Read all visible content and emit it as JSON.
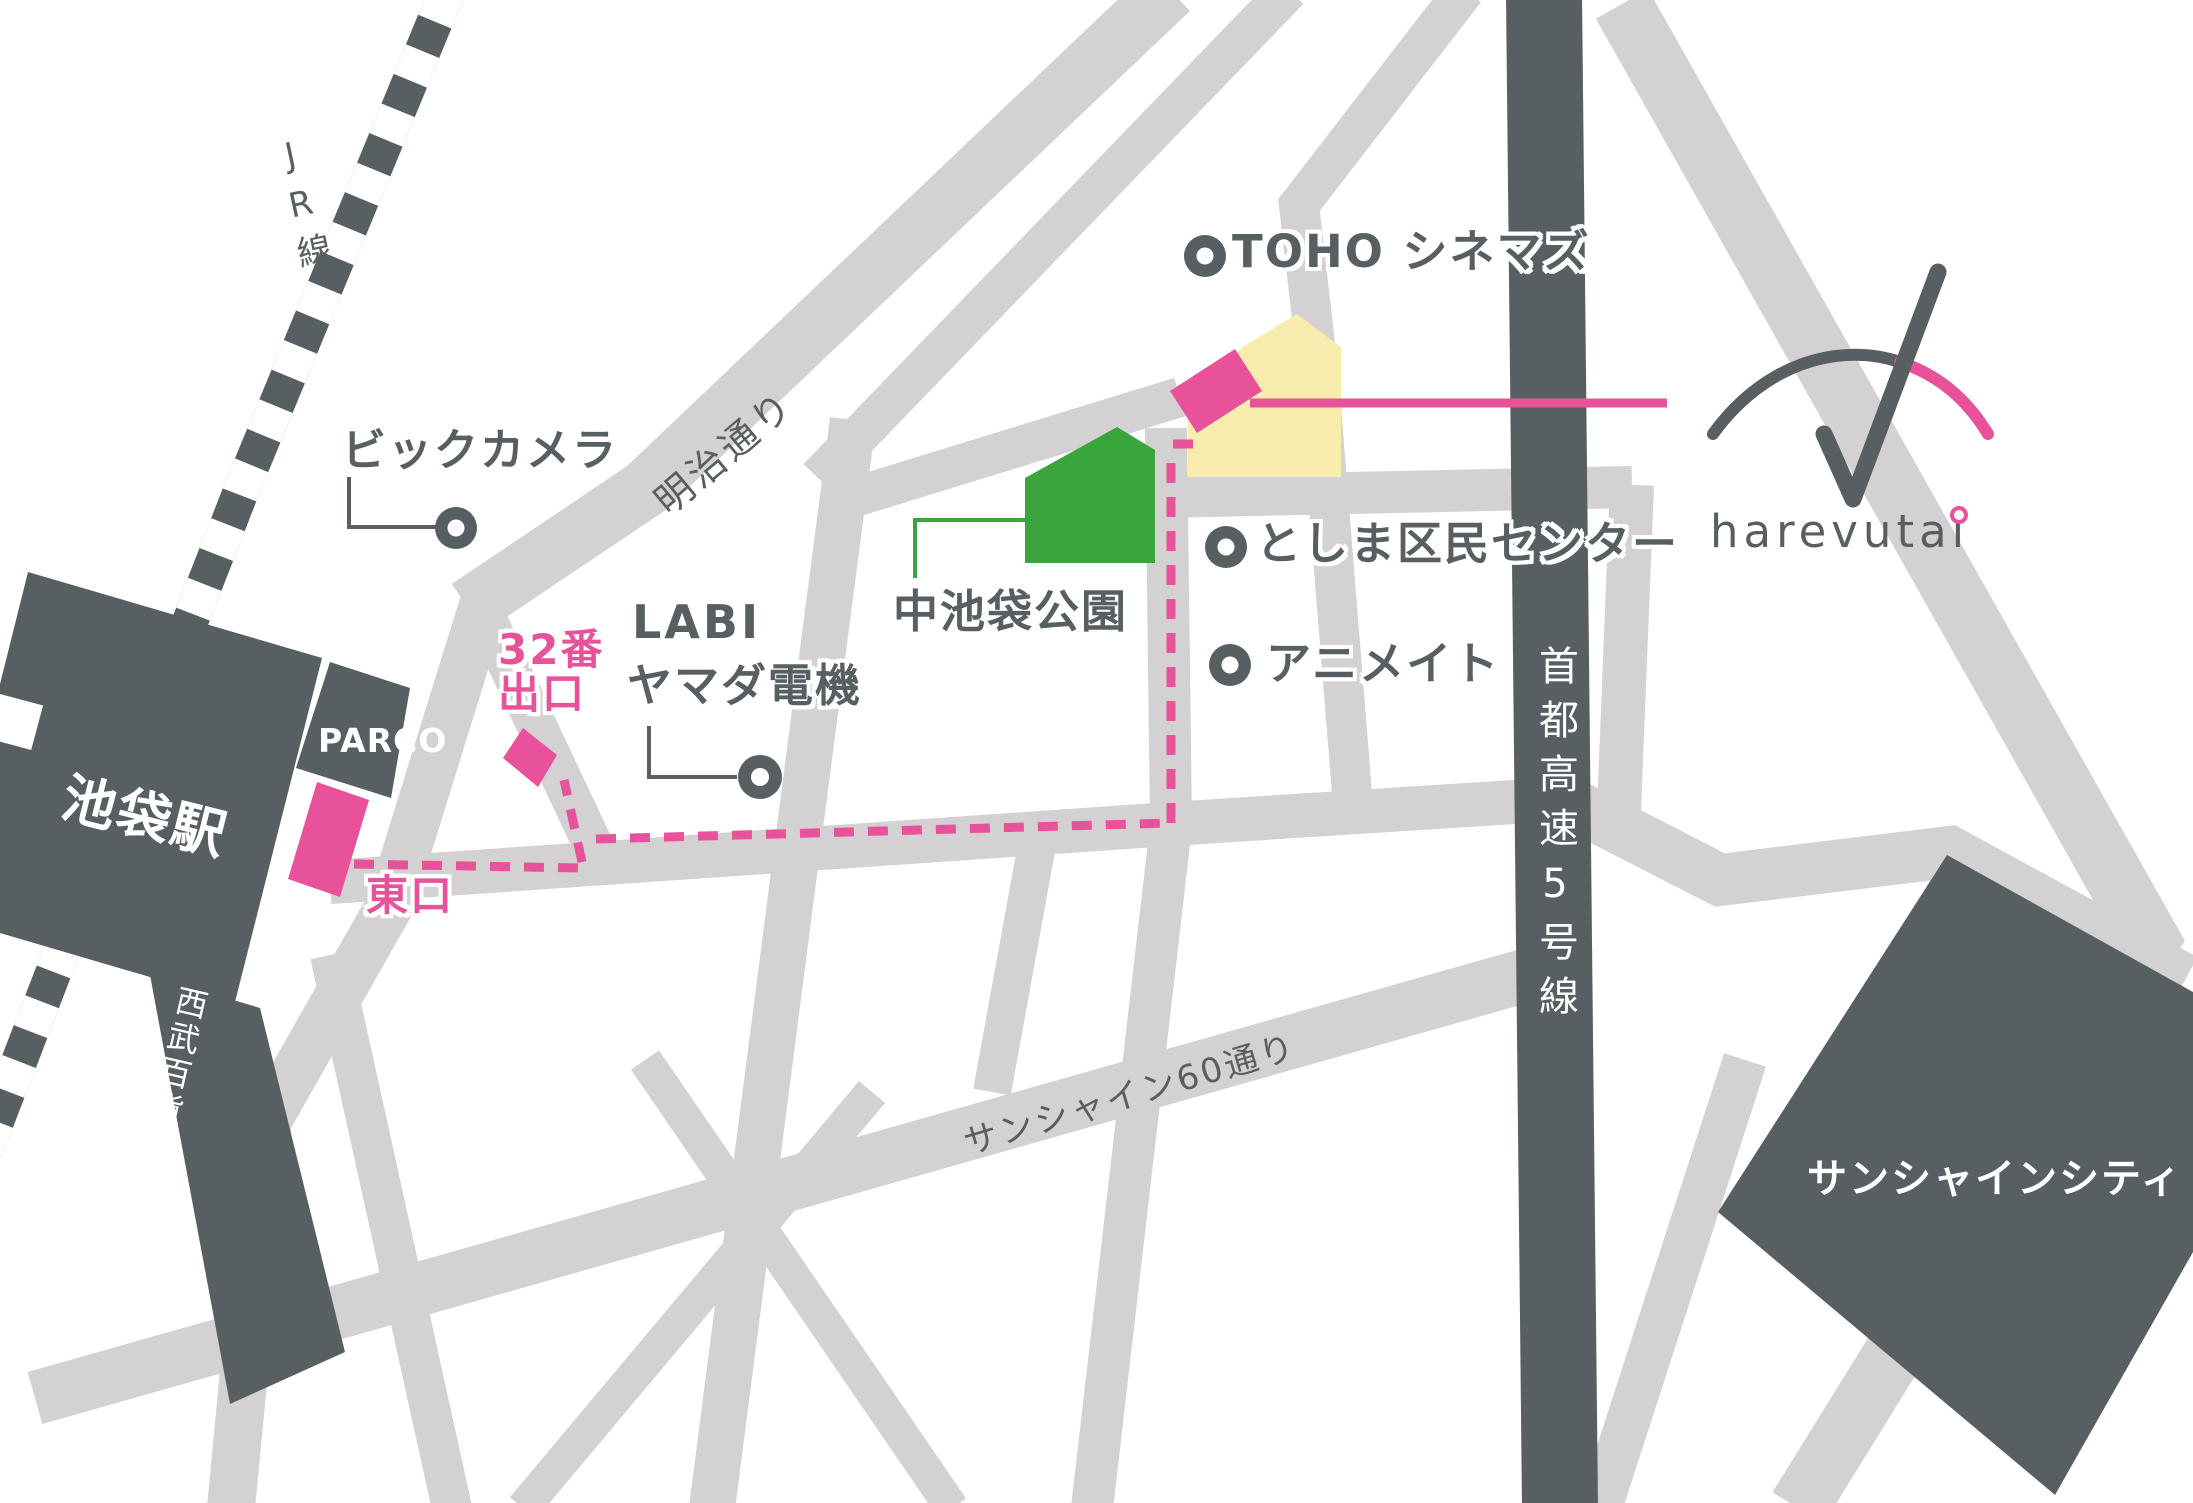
{
  "colors": {
    "map_dark": "#575F63",
    "road_gray": "#D3D1D2",
    "accent_pink": "#E7529B",
    "park_green": "#3AA43D",
    "venue_yellow": "#F8EBAE"
  },
  "brand": {
    "wordmark": "harevutai"
  },
  "labels": {
    "jr_line": "JR線",
    "ikebukuro_station": "池袋駅",
    "seibu_department_store": "西武百貨店",
    "parco": "PARCO",
    "east_exit": "東口",
    "exit_32_line1": "32番",
    "exit_32_line2": "出口",
    "bic_camera": "ビックカメラ",
    "labi_line1": "LABI",
    "labi_line2": "ヤマダ電機",
    "meiji_dori": "明治通り",
    "naka_ikebukuro_park": "中池袋公園",
    "toho_cinemas": "TOHO シネマズ",
    "toshima_civic_center": "としま区民センター",
    "animate": "アニメイト",
    "shuto_expressway_5": "首都高速5号線",
    "sunshine_60_street": "サンシャイン60通り",
    "sunshine_city": "サンシャインシティ"
  }
}
